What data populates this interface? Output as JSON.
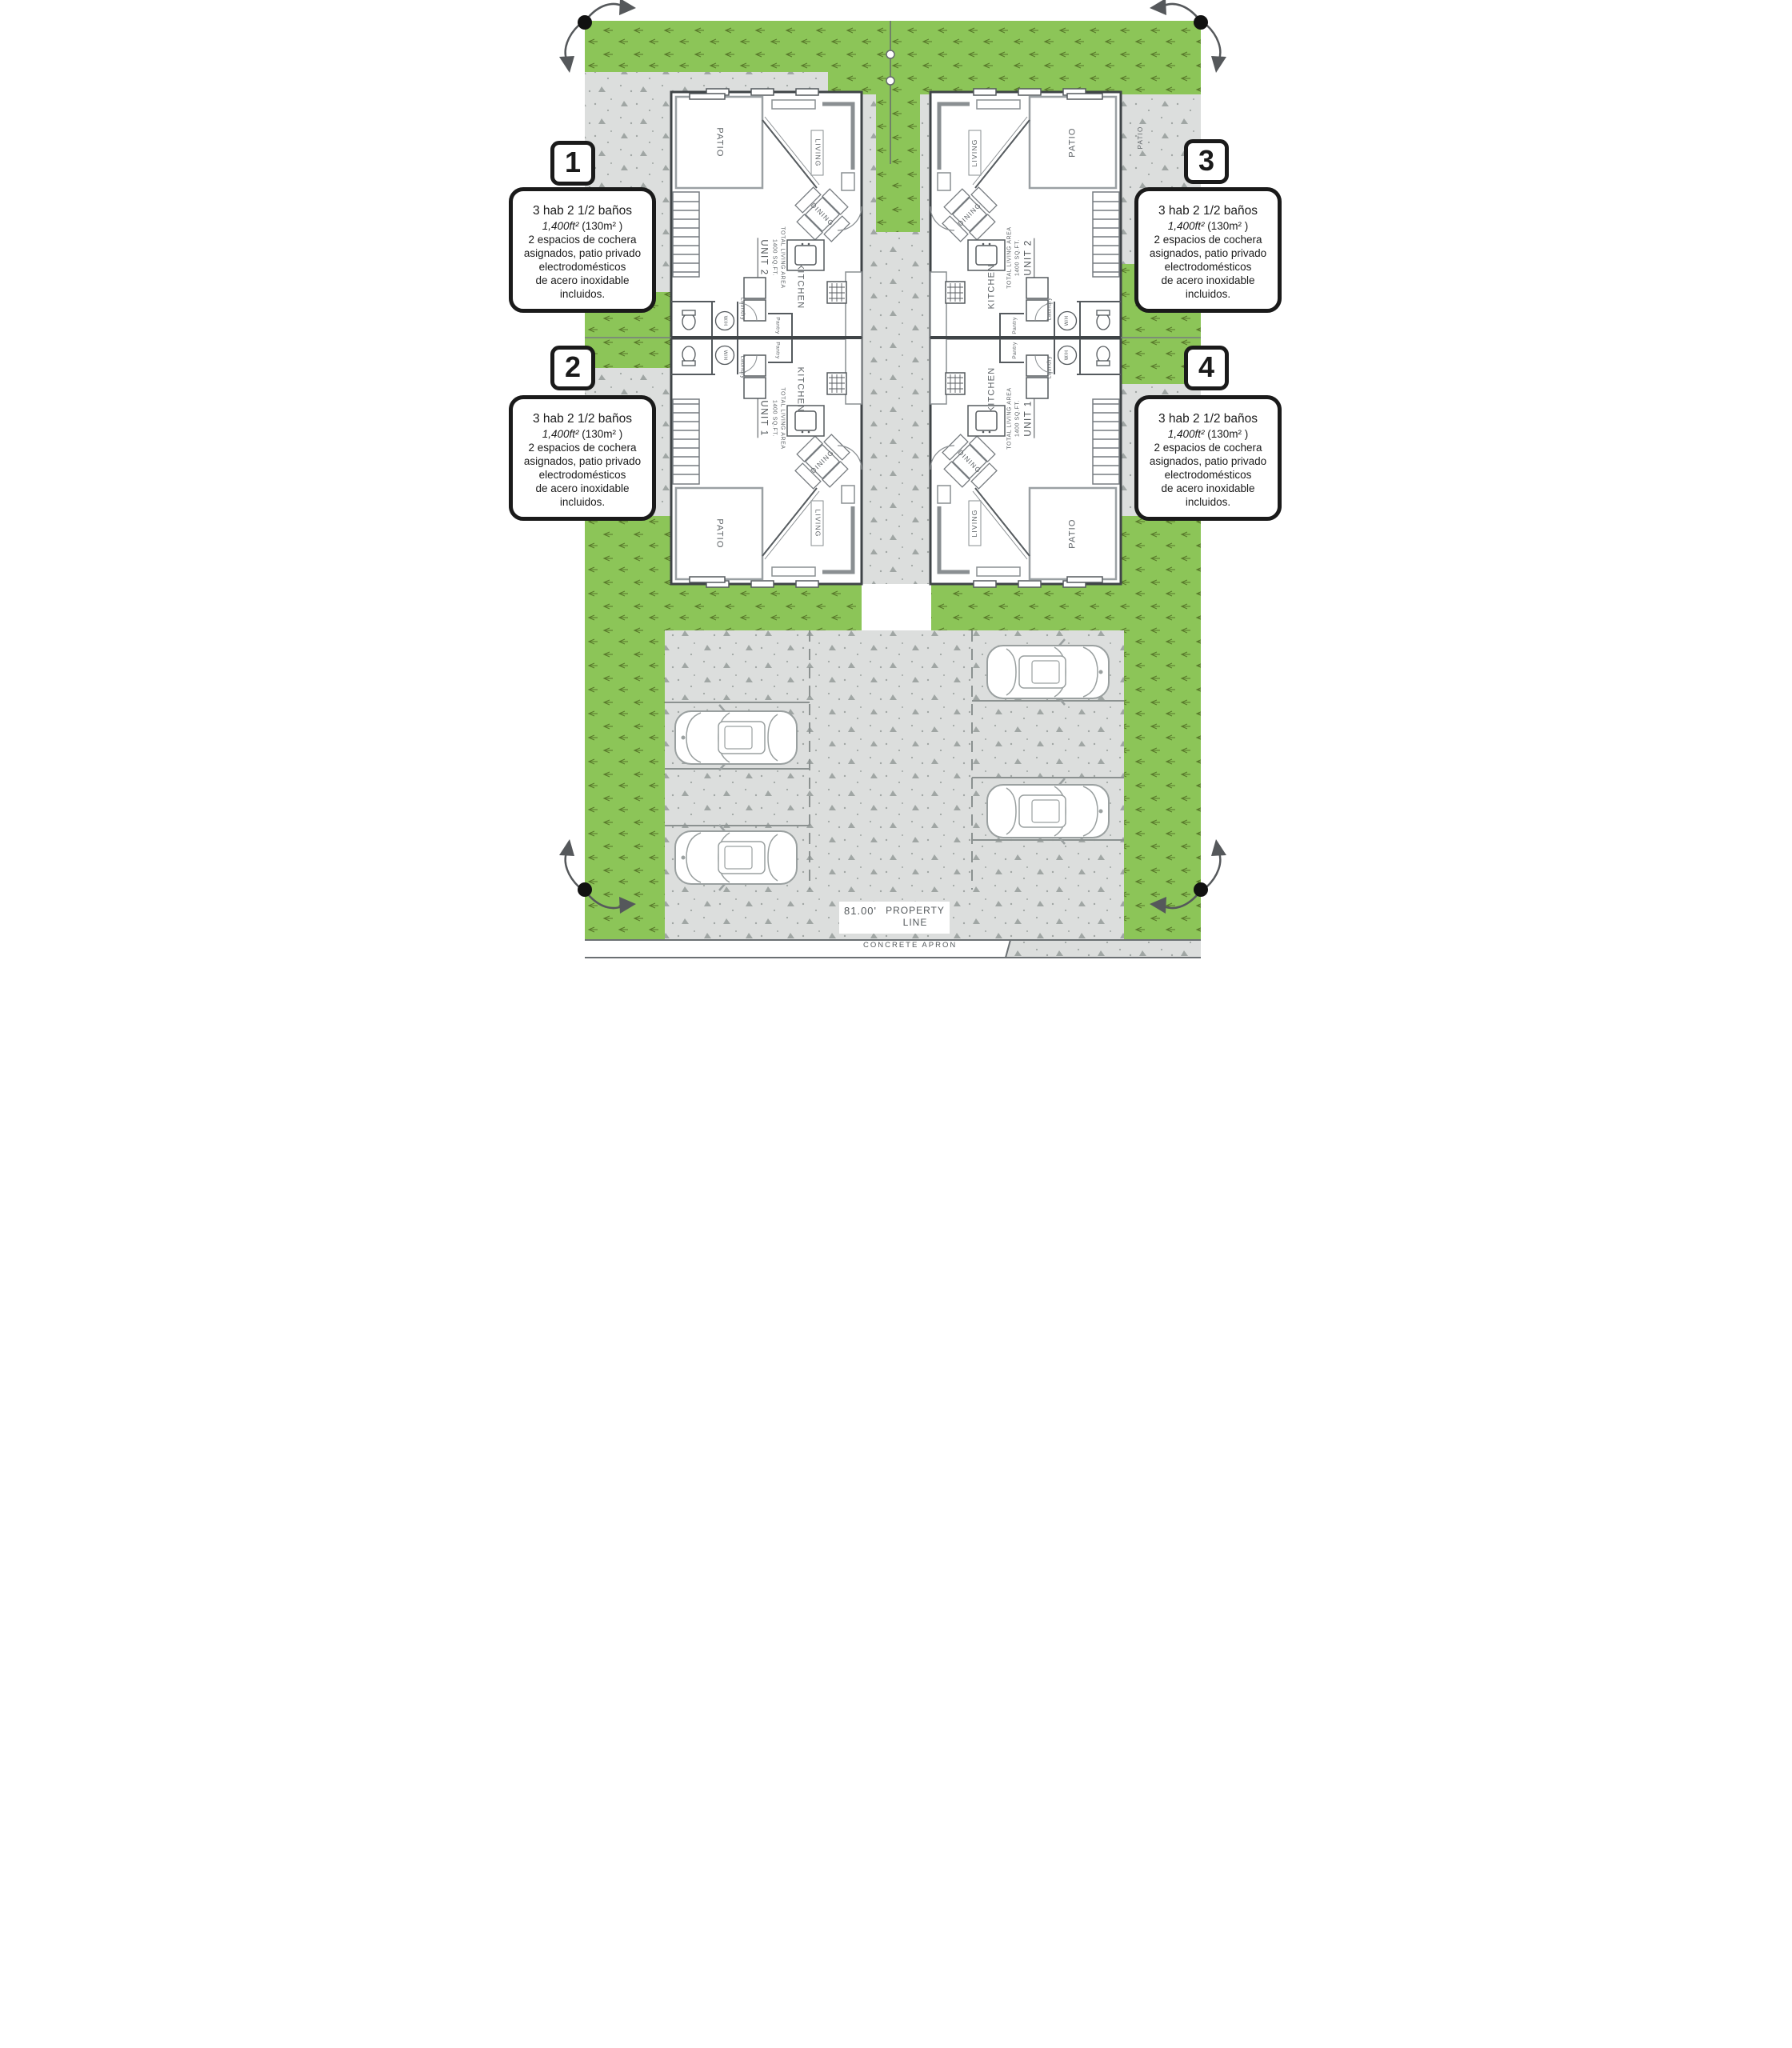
{
  "colors": {
    "grass": "#8cc558",
    "grass_hatch": "#4e6b22",
    "concrete": "#dcdedd",
    "concrete_speckle": "#8f9693",
    "wall": "#3f4447",
    "plan_line": "#555a5e",
    "label_text": "#5d6266",
    "callout_border": "#1a1a1a"
  },
  "icons": {
    "corner_marker": "survey-point-dot-with-rotation-arrows",
    "utility_line": "vertical-utility-line-with-circles",
    "car": "car-top-view-outline"
  },
  "rooms": {
    "patio": "PATIO",
    "living": "LIVING",
    "dining": "DINING",
    "kitchen": "KITCHEN",
    "laundry": "Laundry",
    "pantry": "Pantry",
    "water_heater": "W/H",
    "unit_1": "UNIT 1",
    "unit_2": "UNIT 2",
    "total_living_area": "TOTAL LIVING AREA",
    "area_sqft": "1400 SQ.FT."
  },
  "site": {
    "dimension": "81.00'",
    "property_line_label": "PROPERTY LINE",
    "concrete_apron_label": "CONCRETE  APRON"
  },
  "callouts": [
    {
      "number": "1",
      "line1": "3 hab 2 1/2 baños",
      "area_ft": "1,400ft²",
      "area_m": " (130m² )",
      "line3": "2 espacios de cochera",
      "line4": "asignados, patio privado",
      "line5": "electrodomésticos",
      "line6": "de acero inoxidable incluidos."
    },
    {
      "number": "2",
      "line1": "3 hab 2 1/2 baños",
      "area_ft": "1,400ft²",
      "area_m": " (130m² )",
      "line3": "2 espacios de cochera",
      "line4": "asignados, patio privado",
      "line5": "electrodomésticos",
      "line6": "de acero inoxidable incluidos."
    },
    {
      "number": "3",
      "line1": "3 hab 2 1/2 baños",
      "area_ft": "1,400ft²",
      "area_m": " (130m² )",
      "line3": "2 espacios de cochera",
      "line4": "asignados, patio privado",
      "line5": "electrodomésticos",
      "line6": "de acero inoxidable incluidos."
    },
    {
      "number": "4",
      "line1": "3 hab 2 1/2 baños",
      "area_ft": "1,400ft²",
      "area_m": " (130m² )",
      "line3": "2 espacios de cochera",
      "line4": "asignados, patio privado",
      "line5": "electrodomésticos",
      "line6": "de acero inoxidable incluidos."
    }
  ]
}
